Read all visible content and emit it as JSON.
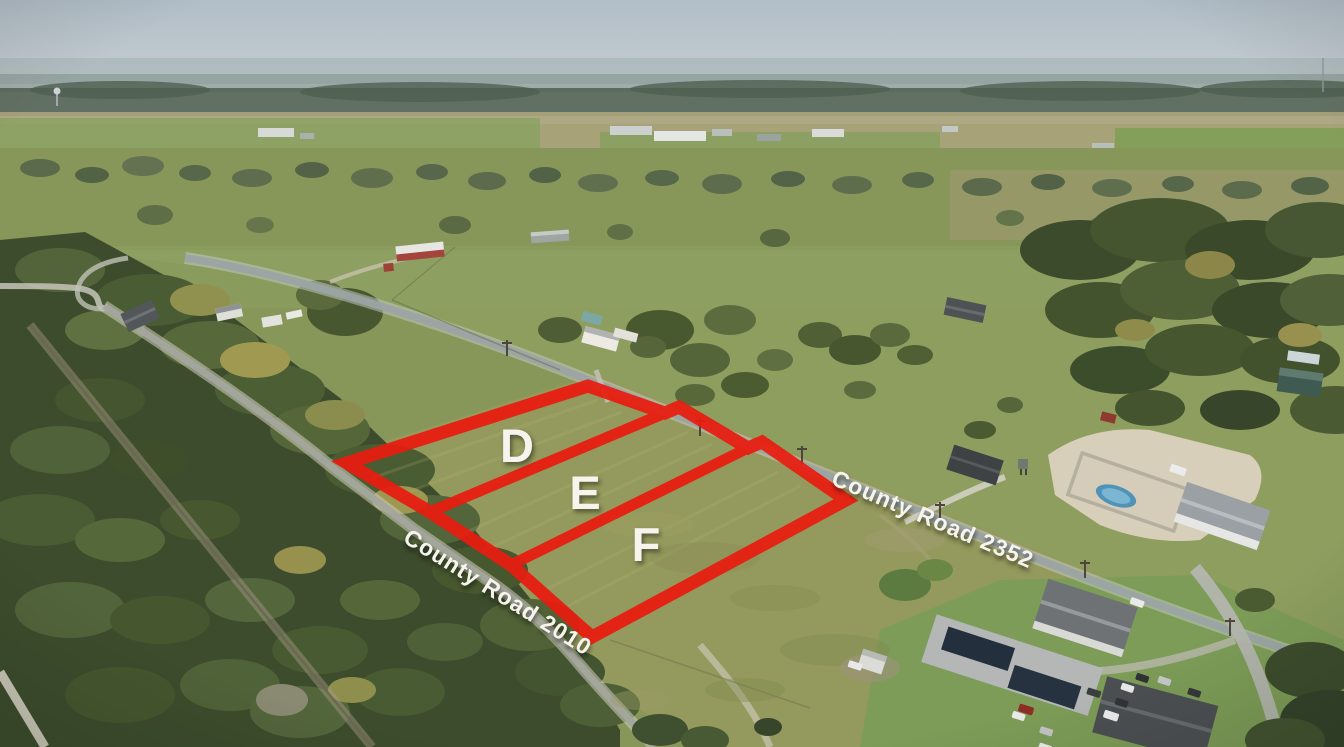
{
  "overlay": {
    "outline_color": "#e91c10",
    "label_color": "#f6f4ed",
    "parcels": [
      {
        "label": "D"
      },
      {
        "label": "E"
      },
      {
        "label": "F"
      }
    ],
    "road_labels": [
      {
        "label": "County Road 2010"
      },
      {
        "label": "County Road 2352"
      }
    ]
  }
}
